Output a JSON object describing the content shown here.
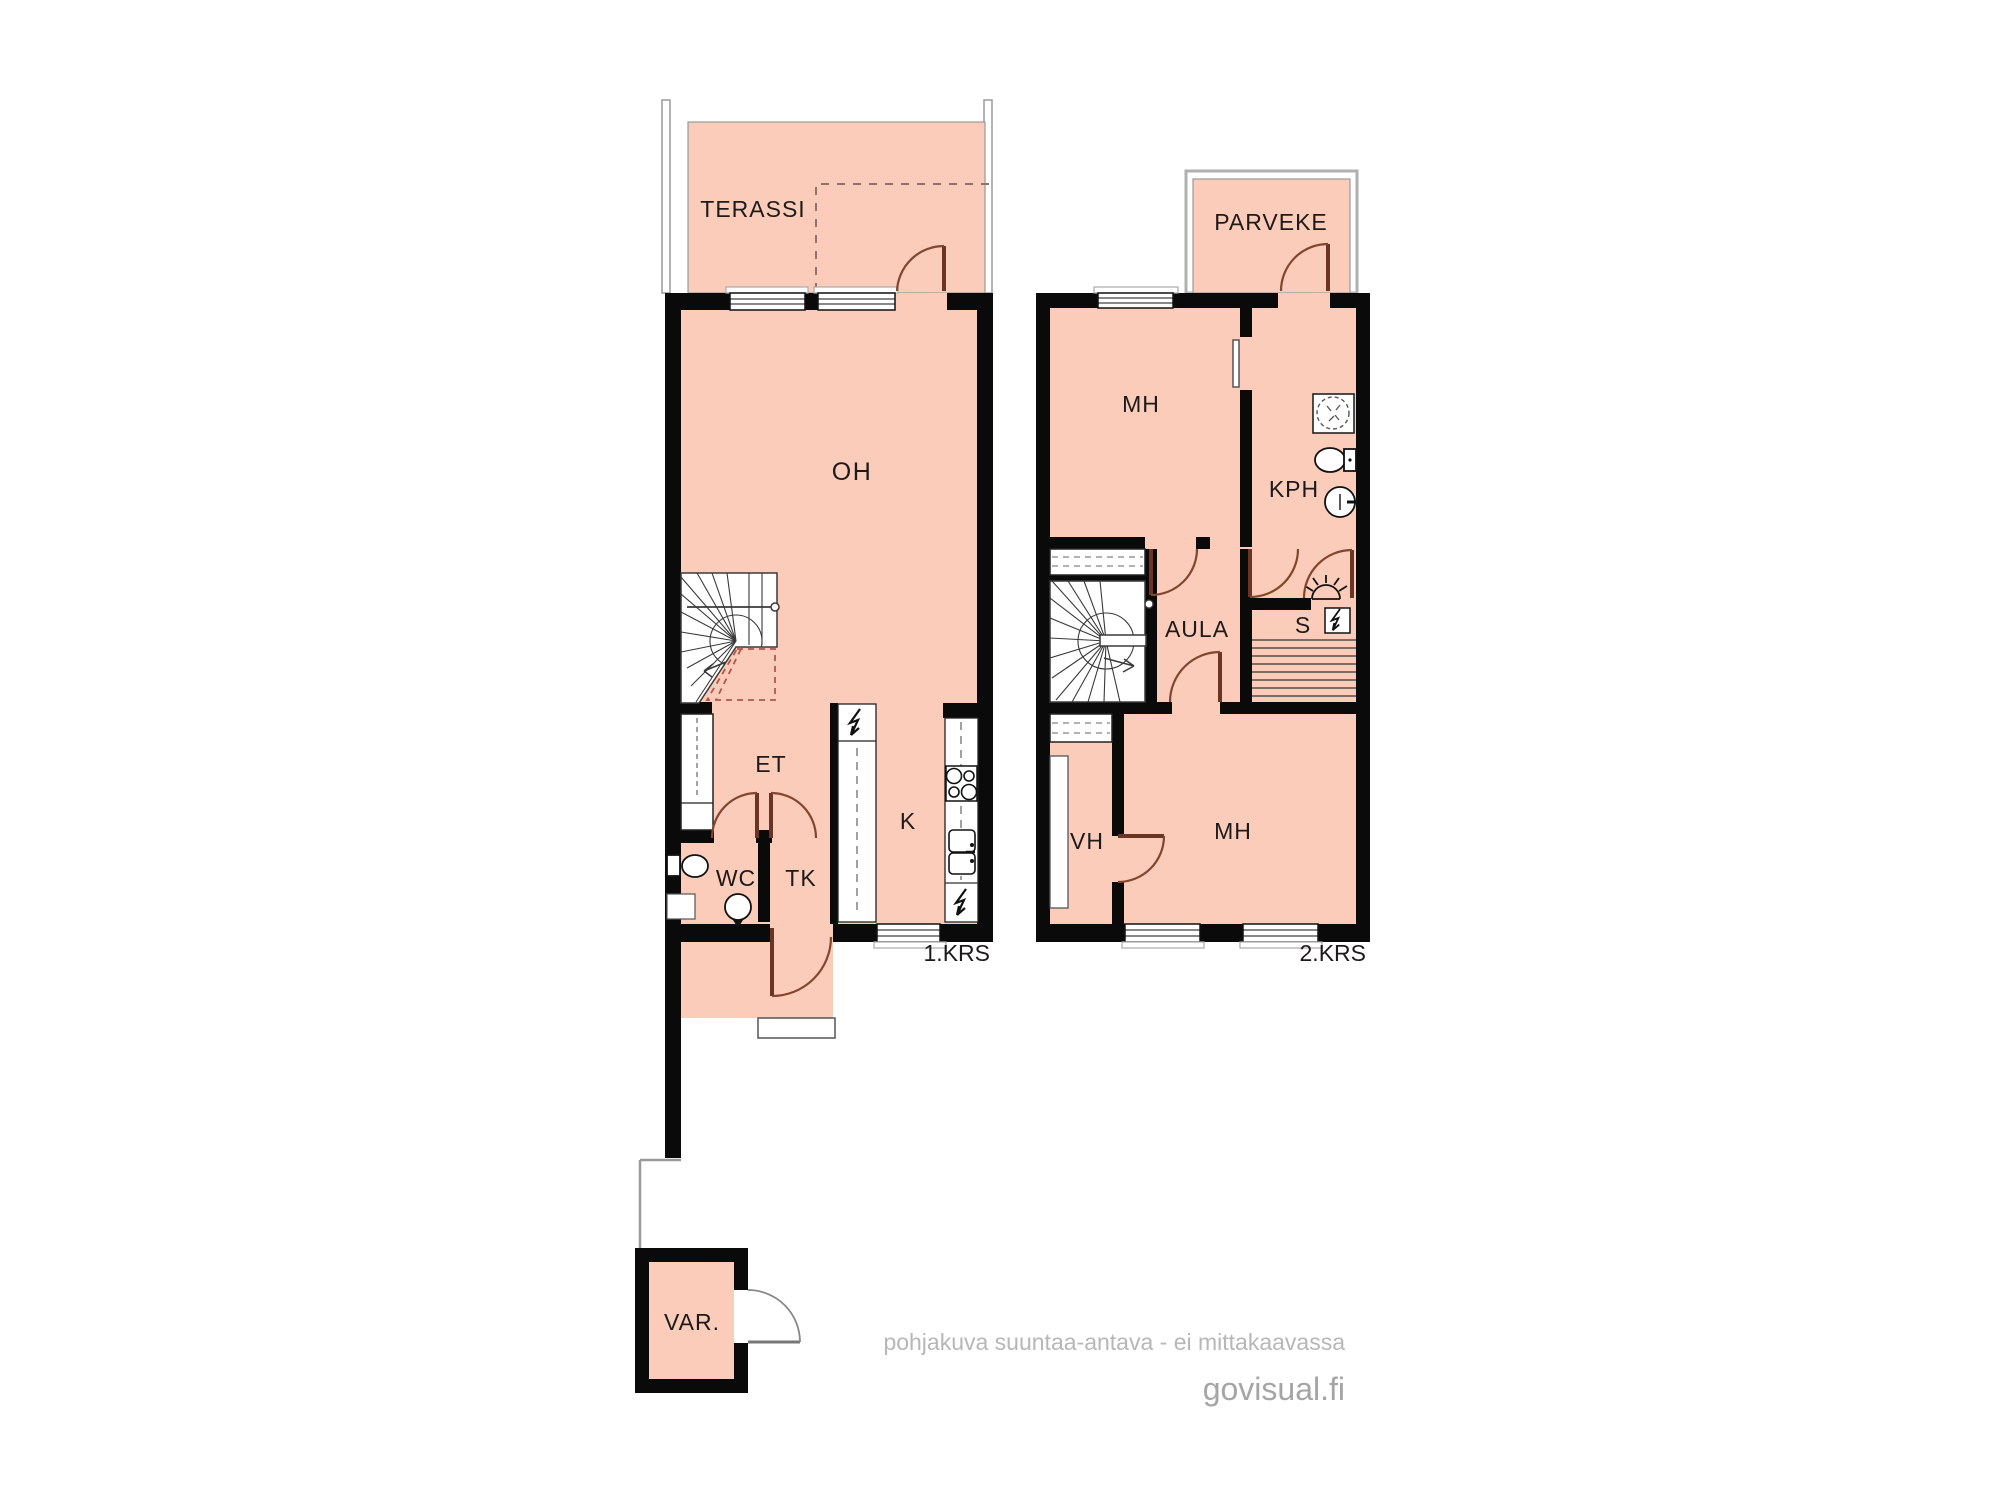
{
  "colors": {
    "floor_fill": "#fbccba",
    "wall": "#0a0a0a",
    "door_arc": "#82462f",
    "label_text": "#1d1a1a",
    "terrace_outline": "#9a9a9a",
    "footer_text": "#b7b7b7",
    "brand_text": "#a5a5a5"
  },
  "floor1": {
    "label": "1.KRS",
    "rooms": {
      "terassi": "TERASSI",
      "oh": "OH",
      "et": "ET",
      "wc": "WC",
      "tk": "TK",
      "k": "K"
    }
  },
  "floor2": {
    "label": "2.KRS",
    "rooms": {
      "parveke": "PARVEKE",
      "mh_upper": "MH",
      "kph": "KPH",
      "aula": "AULA",
      "s": "S",
      "vh": "VH",
      "mh_lower": "MH"
    }
  },
  "outbuilding": {
    "label": "VAR."
  },
  "footer": {
    "disclaimer": "pohjakuva suuntaa-antava - ei mittakaavassa",
    "brand": "govisual.fi"
  }
}
